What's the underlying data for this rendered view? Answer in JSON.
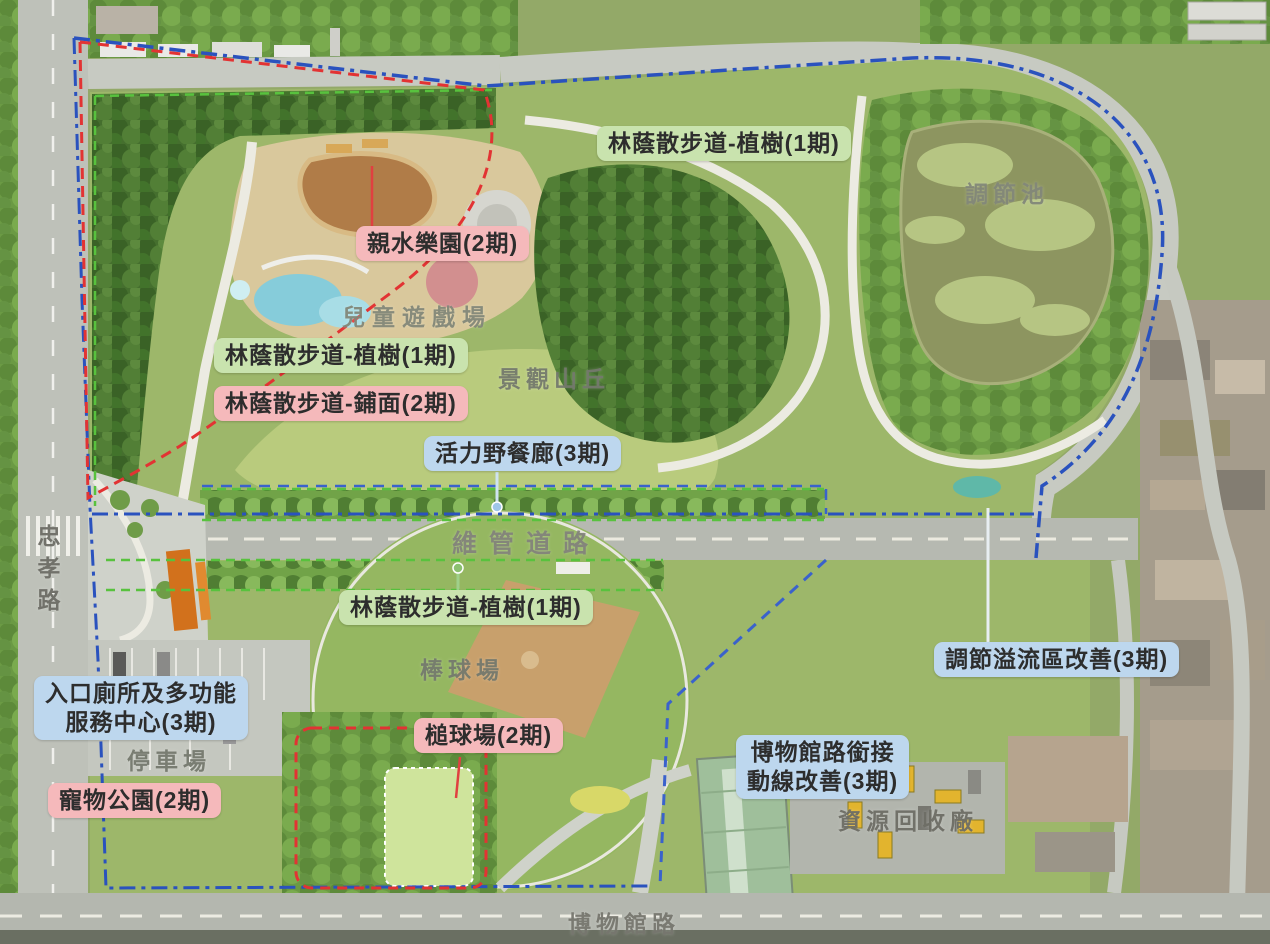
{
  "callouts": [
    {
      "text": "林蔭散步道-植樹(1期)",
      "type": "green"
    },
    {
      "text": "親水樂園(2期)",
      "type": "pink"
    },
    {
      "text": "林蔭散步道-植樹(1期)",
      "type": "green"
    },
    {
      "text": "林蔭散步道-鋪面(2期)",
      "type": "pink"
    },
    {
      "text": "活力野餐廊(3期)",
      "type": "blue"
    },
    {
      "text": "林蔭散步道-植樹(1期)",
      "type": "green"
    },
    {
      "lines": [
        "入口廁所及多功能",
        "服務中心(3期)"
      ],
      "type": "blue"
    },
    {
      "text": "寵物公園(2期)",
      "type": "pink"
    },
    {
      "text": "槌球場(2期)",
      "type": "pink"
    },
    {
      "lines": [
        "博物館路銜接",
        "動線改善(3期)"
      ],
      "type": "blue"
    },
    {
      "text": "調節溢流區改善(3期)",
      "type": "blue"
    }
  ],
  "place_labels": [
    {
      "text": "調節池"
    },
    {
      "text": "兒童遊戲場"
    },
    {
      "text": "景觀山丘"
    },
    {
      "text": "棒球場"
    },
    {
      "text": "停車場"
    },
    {
      "text": "資源回收廠"
    },
    {
      "text": "維管道路"
    },
    {
      "text": "忠孝路"
    },
    {
      "text": "博物館路"
    }
  ],
  "legend_colors": {
    "phase1_green": "#c9e3ae",
    "phase2_pink": "#f5b9bb",
    "phase3_blue": "#bdd7ee",
    "red_boundary": "#e23333",
    "blue_boundary": "#2a52be",
    "green_line": "#58c23e"
  }
}
